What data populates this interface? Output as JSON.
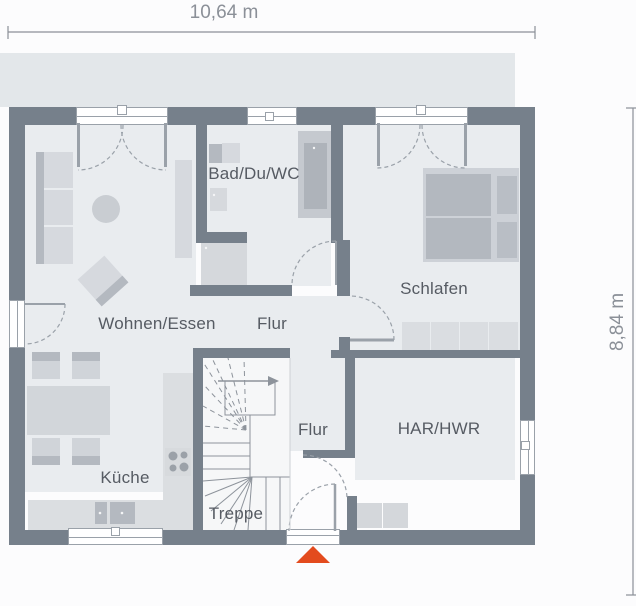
{
  "dimensions": {
    "width": "10,64 m",
    "height": "8,84 m"
  },
  "rooms": {
    "living": {
      "label": "Wohnen/Essen"
    },
    "bath": {
      "label": "Bad/Du/WC"
    },
    "bedroom": {
      "label": "Schlafen"
    },
    "hall_upper": {
      "label": "Flur"
    },
    "hall_lower": {
      "label": "Flur"
    },
    "utility": {
      "label": "HAR/HWR"
    },
    "kitchen": {
      "label": "Küche"
    },
    "stairs": {
      "label": "Treppe"
    }
  },
  "colors": {
    "wall": "#76808b",
    "floor": "#e9ecef",
    "terrace": "#e3e7ea",
    "furn_light": "#d6d9de",
    "furn_mid": "#c9cdd2",
    "furn_dark": "#b4b9c0",
    "line": "#9aa1a9",
    "label_text": "#565b63",
    "dim_text": "#8b9098",
    "red": "#e34b1e",
    "stair_line": "#8d939b"
  }
}
